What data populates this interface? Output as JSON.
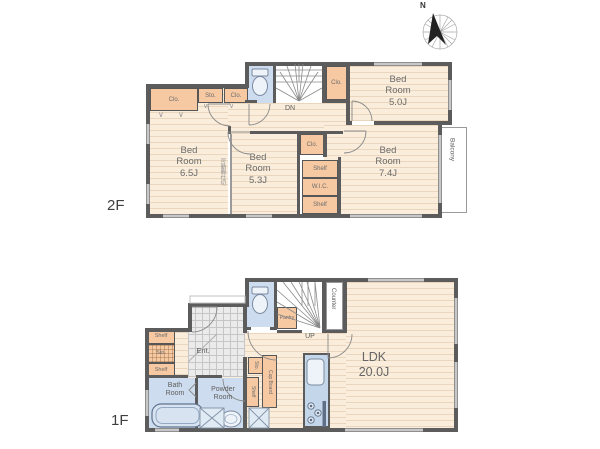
{
  "compass": {
    "north": "N"
  },
  "shared": {
    "closet": "Clo.",
    "storage": "Sto.",
    "shelf": "Shelf",
    "chevron": "∨"
  },
  "floor2": {
    "tag": "2F",
    "balcony": "Balcony",
    "stairs_dir": "DN",
    "wic": "W.I.C.",
    "partition_note": "可動間仕切",
    "rooms": {
      "bedroom_ne": {
        "name": "Bed Room",
        "size": "5.0J"
      },
      "bedroom_w": {
        "name": "Bed Room",
        "size": "6.5J"
      },
      "bedroom_c": {
        "name": "Bed Room",
        "size": "5.3J"
      },
      "bedroom_se": {
        "name": "Bed Room",
        "size": "7.4J"
      }
    }
  },
  "floor1": {
    "tag": "1F",
    "stairs_dir": "UP",
    "entrance": "Ent.",
    "counter": "Counter",
    "pantry": "Pantry",
    "cupboard": "Cup Board",
    "rooms": {
      "ldk": {
        "name": "LDK",
        "size": "20.0J"
      },
      "bath": {
        "name": "Bath Room"
      },
      "powder": {
        "name": "Powder Room"
      }
    }
  },
  "colors": {
    "wall": "#5c5c5c",
    "wood_floor": "#faeddb",
    "closet_orange": "#f6c9a2",
    "wet_blue": "#cddcee",
    "tile_gray": "#ebebeb"
  }
}
